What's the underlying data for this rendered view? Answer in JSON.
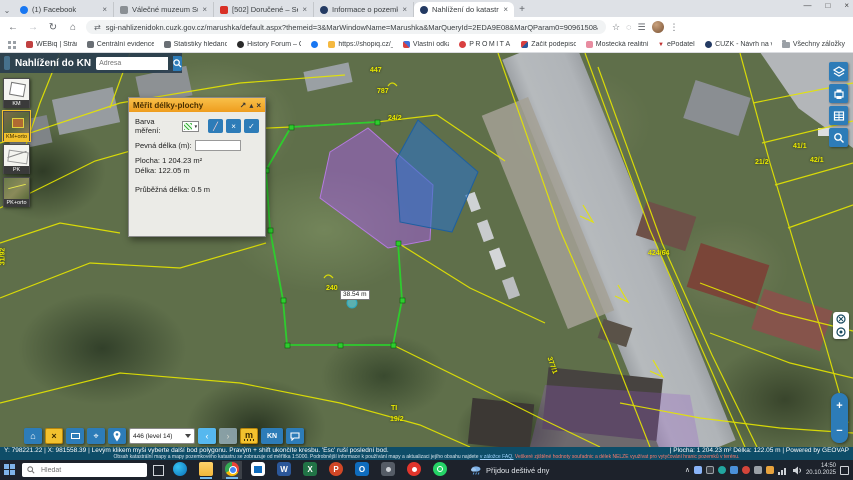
{
  "browser": {
    "tab_chevron": "⌄",
    "tabs": [
      {
        "title": "(1) Facebook"
      },
      {
        "title": "Válečné muzeum Sudety"
      },
      {
        "title": "[502] Doručené – Seznam Email"
      },
      {
        "title": "Informace o pozemku | Nahlíž..."
      },
      {
        "title": "Nahlížení do katastru nemovit..."
      }
    ],
    "new_tab": "+",
    "window": {
      "minimize": "—",
      "maximize": "□",
      "close": "×"
    },
    "nav": {
      "back": "←",
      "forward": "→",
      "reload": "↻",
      "home": "⌂"
    },
    "url": "sgi-nahlizenidokn.cuzk.gov.cz/marushka/default.aspx?themeid=3&MarWindowName=Marushka&MarQueryId=2EDA9E08&MarQParam0=90961508&MarQParamCount=1",
    "actions": {
      "bookmark": "☆",
      "menu": "⋮"
    },
    "bookmarks": [
      {
        "label": "WEBiq | Stránky"
      },
      {
        "label": "Centrální evidence e..."
      },
      {
        "label": "Statistiky hledanost..."
      },
      {
        "label": "History Forum – Ob..."
      },
      {
        "label": "https://shopiq.cz/_si..."
      },
      {
        "label": "Vlastní odkazy"
      },
      {
        "label": "PROMÍTÁNÍ"
      },
      {
        "label": "Začít podepisovat"
      },
      {
        "label": "Mostecká realitní a..."
      },
      {
        "label": "ePodatelna"
      },
      {
        "label": "ČÚZK - Návrh na vkl..."
      }
    ],
    "all_bookmarks": "Všechny záložky"
  },
  "app": {
    "title": "Nahlížení do KN",
    "search_placeholder": "Adresa",
    "layers": [
      {
        "label": "KM"
      },
      {
        "label": "KM+orto"
      },
      {
        "label": "PK"
      },
      {
        "label": "PK+orto"
      }
    ]
  },
  "dialog": {
    "title": "Měřit délky-plochy",
    "icons": {
      "open": "↗",
      "collapse": "▴",
      "close": "×"
    },
    "color_label": "Barva měření:",
    "buttons": {
      "draw": "╱",
      "cancel": "×",
      "apply": "✓"
    },
    "fixed_label": "Pevná délka (m):",
    "fixed_value": "",
    "area": "Plocha: 1 204.23 m²",
    "length": "Délka: 122.05 m",
    "running": "Průběžná délka: 0.5 m"
  },
  "map": {
    "labels": [
      {
        "text": "787"
      },
      {
        "text": "24/2"
      },
      {
        "text": "447"
      },
      {
        "text": "21/2"
      },
      {
        "text": "41/1"
      },
      {
        "text": "42/1"
      },
      {
        "text": "424/64"
      },
      {
        "text": "31/92"
      },
      {
        "text": "19/2"
      },
      {
        "text": "TI"
      },
      {
        "text": "377/1"
      },
      {
        "text": "240"
      }
    ],
    "measure_label": "38.54 m",
    "zoom_in": "+",
    "zoom_out": "−"
  },
  "toolbar": {
    "glyphs": {
      "home": "⌂",
      "clear": "×",
      "target": "⌖",
      "back": "‹",
      "fwd": "›"
    },
    "level": "446 (level 14)",
    "measure": "m",
    "kn": "KN"
  },
  "status": {
    "coords": "Y: 798221.22  | X: 981558.39  |",
    "hint": "Levým klikem myši vyberte další bod polygonu. Pravým + shift ukončíte kresbu. 'Esc' ruší poslední bod.",
    "note1": "Obsah katastrální mapy a mapy pozemkového katastru se zobrazuje od měřítka 1:5000. Podrobnější informace k používání mapy a aktualizaci jejího obsahu najdete",
    "note_link": "v záložce FAQ.",
    "note_red": "Veškeré zjištěné hodnoty souřadnic a délek NELZE využívat pro vytyčování hranic pozemků v terénu.",
    "measure_right": "| Plocha: 1 204.23 m² Délka: 122.05 m |",
    "powered": "Powered by GEOVAP"
  },
  "taskbar": {
    "search_placeholder": "Hledat",
    "weather": "Přijdou deštivé dny",
    "tray_chevron": "∧",
    "time": "14:50",
    "date": "20.10.2025",
    "app_glyphs": {
      "word": "W",
      "excel": "X",
      "powerpoint": "P",
      "outlook": "O"
    }
  }
}
